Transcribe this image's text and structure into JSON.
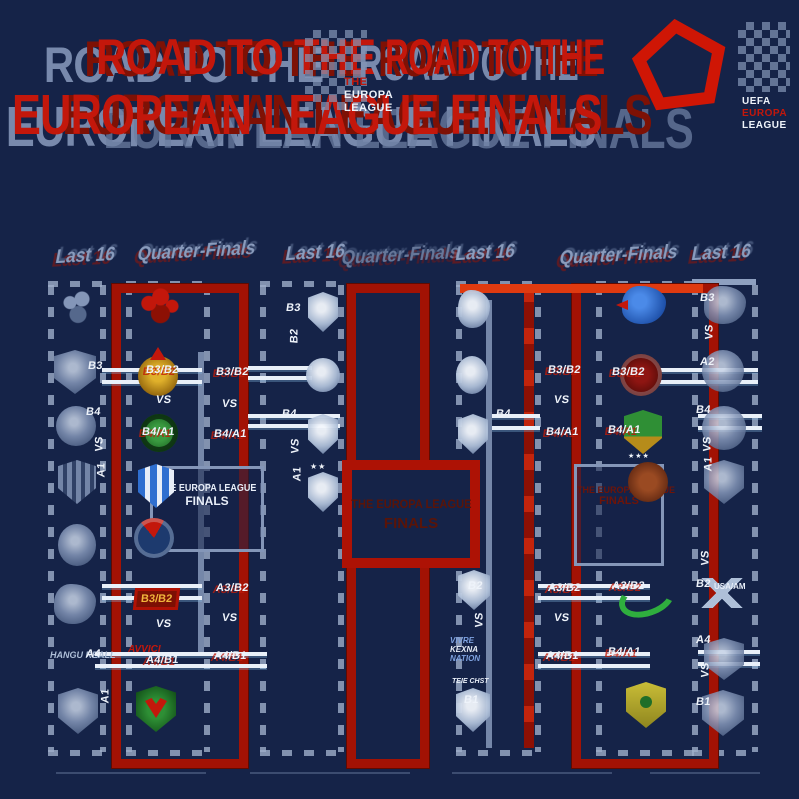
{
  "title": {
    "line1": "ROAD TO THE",
    "line2": "EUROPEAN LEAGUE FINALS"
  },
  "logos": {
    "pentagon": "europa-league-pentagon",
    "center_crest_lines": [
      "THE",
      "EUROPA",
      "LEAGUE"
    ],
    "right_crest_lines": [
      "UEFA",
      "EUROPA",
      "LEAGUE"
    ]
  },
  "headers": {
    "last16": "Last 16",
    "quarter_finals": "Quarter-Finals"
  },
  "final_box": {
    "line1": "THE EUROPA LEAGUE",
    "line2": "FINALS"
  },
  "codes": {
    "left_outer": [
      "B3",
      "B4",
      "VS",
      "A1",
      "A4",
      "A1"
    ],
    "left_qf_inner": [
      "B3/B2",
      "VS",
      "B4/A1",
      "B3/B2",
      "VS",
      "A4/B1"
    ],
    "left_qf_mid": [
      "B3/B2",
      "VS",
      "B4/A1",
      "A3/B2",
      "VS",
      "A4/B1"
    ],
    "center_left": [
      "B3",
      "B2",
      "B4",
      "VS",
      "A1"
    ],
    "center_right": [
      "B4",
      "B2",
      "VS",
      "B1"
    ],
    "right_qf_mid": [
      "B3/B2",
      "VS",
      "B4/A1",
      "A3/B2",
      "VS",
      "A4/B1"
    ],
    "right_qf_inner": [
      "B3/B2",
      "B4/A1",
      "A3/B2",
      "B4/A1"
    ],
    "right_outer": [
      "B3",
      "VS",
      "A2",
      "B4",
      "VS",
      "A1",
      "VS",
      "B2",
      "A4",
      "VS",
      "B1"
    ]
  },
  "crest_texts": {
    "hangu": "HANGU REALL",
    "avvici": "AVVICI",
    "usa_am": "USA/AM",
    "stars_two": "★★",
    "stars_three": "★★★",
    "vivre_lines": [
      "VIVRE",
      "KEXNA",
      "NATION"
    ],
    "teie": "TEIE CHST"
  }
}
